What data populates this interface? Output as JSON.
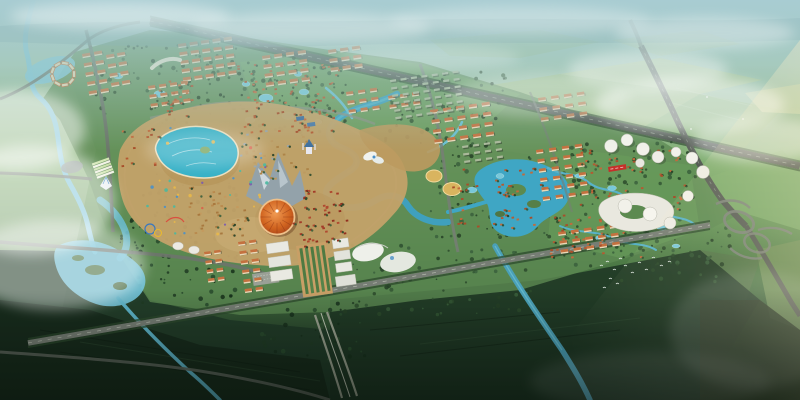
{
  "meta": {
    "title": "Aerial perspective rendering of a master-planned resort city: central theme park with lagoon and orange dome arena, residential districts, villa zones along canals, a lake, white CBD towers, crossing highways with cloverleaf interchange, misty horizon",
    "type": "architectural-aerial-rendering",
    "width_px": 800,
    "height_px": 400
  },
  "palette": {
    "sky_haze": "#a6cacf",
    "far_fields": "#9dbf85",
    "development_green": "#5d8a52",
    "dark_fields": "#1d3424",
    "water": "#55b2cc",
    "lagoon": "#35b0c6",
    "road_gray": "#6d746c",
    "highway_gray": "#555c55",
    "roof_orange": "#c4713f",
    "roof_red": "#a33b28",
    "facade_cream": "#ead9b8",
    "arena_orange": "#c75c24",
    "gold_roof": "#d9b45f",
    "tower_white": "#f2f1ea",
    "plaza_tan": "#c89f66",
    "banner_red": "#c5302a",
    "mist_white": "#ffffff",
    "sun_glow": "#f0d9a0"
  },
  "labels": {
    "sky": "Hazy teal sky over distant plain",
    "theme_park": "Theme park with lagoon, artificial mountain and dome arena",
    "arena": "Orange dome arena",
    "lake": "Central lake with islands",
    "interchange": "Cloverleaf highway interchange",
    "cbd": "White cylindrical tower cluster",
    "wetland": "Wetland park with canals",
    "commercial": "Commercial complex and axis plaza",
    "birds": "Flock of birds over fields"
  },
  "generated": {
    "tree_palette": [
      "#2b4a2c",
      "#335634",
      "#243f26",
      "#3a5f3c"
    ],
    "villa_palette": [
      "#b55a31",
      "#c26a3c",
      "#a84e2a"
    ],
    "roof_color": "#c4713f",
    "facade_color": "#ead9b8",
    "dense_roof": "#aab89a",
    "shadow_color": "#2f3a2c",
    "pond_color": "#78c8da",
    "bird_color": "#f2f7f4",
    "tree_regions": [
      {
        "x": 236,
        "y": 58,
        "w": 112,
        "h": 80,
        "n": 90,
        "s": 101
      },
      {
        "x": 86,
        "y": 42,
        "w": 150,
        "h": 72,
        "n": 70,
        "s": 102
      },
      {
        "x": 385,
        "y": 72,
        "w": 125,
        "h": 75,
        "n": 70,
        "s": 103
      },
      {
        "x": 430,
        "y": 155,
        "w": 120,
        "h": 85,
        "n": 85,
        "s": 104
      },
      {
        "x": 555,
        "y": 142,
        "w": 145,
        "h": 125,
        "n": 120,
        "s": 105
      },
      {
        "x": 115,
        "y": 190,
        "w": 125,
        "h": 115,
        "n": 95,
        "s": 106,
        "pal": [
          "#1e3a22",
          "#27492b",
          "#16301a"
        ]
      },
      {
        "x": 345,
        "y": 245,
        "w": 190,
        "h": 70,
        "n": 70,
        "s": 107
      },
      {
        "x": 615,
        "y": 228,
        "w": 115,
        "h": 55,
        "n": 45,
        "s": 108
      },
      {
        "x": 150,
        "y": 115,
        "w": 90,
        "h": 90,
        "n": 60,
        "s": 109
      },
      {
        "x": 250,
        "y": 300,
        "w": 120,
        "h": 60,
        "n": 40,
        "s": 110,
        "pal": [
          "#203c24",
          "#2a4c2e",
          "#182f1c"
        ]
      }
    ],
    "building_clusters": [
      {
        "x": 82,
        "y": 54,
        "cols": 2,
        "rows": 5,
        "dx": 12,
        "dy": 9.5,
        "w": 8,
        "h": 3.2,
        "a": -10
      },
      {
        "x": 106,
        "y": 55,
        "cols": 2,
        "rows": 4,
        "dx": 11,
        "dy": 9.5,
        "w": 8,
        "h": 3.2,
        "a": -10
      },
      {
        "x": 178,
        "y": 44,
        "cols": 5,
        "rows": 5,
        "dx": 11.5,
        "dy": 8.5,
        "w": 8,
        "h": 3.2,
        "a": -8
      },
      {
        "x": 148,
        "y": 86,
        "cols": 4,
        "rows": 3,
        "dx": 11,
        "dy": 9,
        "w": 7,
        "h": 3,
        "a": -8
      },
      {
        "x": 262,
        "y": 56,
        "cols": 4,
        "rows": 4,
        "dx": 12,
        "dy": 9,
        "w": 8,
        "h": 3.2,
        "a": -8
      },
      {
        "x": 328,
        "y": 50,
        "cols": 3,
        "rows": 3,
        "dx": 12,
        "dy": 9,
        "w": 8,
        "h": 3.2,
        "a": -8
      },
      {
        "x": 346,
        "y": 92,
        "cols": 3,
        "rows": 3,
        "dx": 12,
        "dy": 9,
        "w": 7,
        "h": 3,
        "a": -8
      },
      {
        "x": 388,
        "y": 96,
        "cols": 3,
        "rows": 2,
        "dx": 12,
        "dy": 9,
        "w": 7,
        "h": 3,
        "a": -8
      },
      {
        "x": 430,
        "y": 110,
        "cols": 5,
        "rows": 4,
        "dx": 13,
        "dy": 10,
        "w": 8,
        "h": 3.2,
        "a": -8
      },
      {
        "x": 538,
        "y": 98,
        "cols": 4,
        "rows": 3,
        "dx": 13,
        "dy": 10,
        "w": 7.5,
        "h": 3,
        "a": -8,
        "o": 0.85
      },
      {
        "x": 536,
        "y": 150,
        "cols": 4,
        "rows": 6,
        "dx": 13,
        "dy": 9.5,
        "w": 7,
        "h": 3,
        "a": -8
      },
      {
        "x": 558,
        "y": 232,
        "cols": 5,
        "rows": 3,
        "dx": 13,
        "dy": 9,
        "w": 7.5,
        "h": 3,
        "a": -8
      },
      {
        "x": 238,
        "y": 242,
        "cols": 2,
        "rows": 6,
        "dx": 11,
        "dy": 9.5,
        "w": 7,
        "h": 3,
        "a": -8
      },
      {
        "x": 204,
        "y": 252,
        "cols": 2,
        "rows": 4,
        "dx": 10,
        "dy": 9,
        "w": 6.5,
        "h": 2.8,
        "a": -8
      },
      {
        "x": 390,
        "y": 80,
        "cols": 7,
        "rows": 6,
        "dx": 10.5,
        "dy": 7.5,
        "w": 6,
        "h": 2.2,
        "a": -8,
        "style": "dense"
      },
      {
        "x": 462,
        "y": 146,
        "cols": 4,
        "rows": 3,
        "dx": 11,
        "dy": 7.5,
        "w": 6,
        "h": 2.2,
        "a": -8,
        "style": "dense"
      },
      {
        "ring": true,
        "cx": 63,
        "cy": 74,
        "r": 11,
        "count": 9,
        "w": 6.5,
        "h": 3
      }
    ],
    "villa_regions": [
      {
        "x": 236,
        "y": 64,
        "w": 104,
        "h": 68,
        "n": 78,
        "s": 7
      },
      {
        "x": 150,
        "y": 80,
        "w": 48,
        "h": 36,
        "n": 20,
        "s": 11
      },
      {
        "x": 576,
        "y": 148,
        "w": 112,
        "h": 64,
        "n": 58,
        "s": 13
      },
      {
        "x": 548,
        "y": 214,
        "w": 92,
        "h": 46,
        "n": 38,
        "s": 17
      },
      {
        "x": 452,
        "y": 168,
        "w": 92,
        "h": 60,
        "n": 46,
        "s": 19
      },
      {
        "x": 118,
        "y": 128,
        "w": 40,
        "h": 38,
        "n": 13,
        "s": 23
      },
      {
        "x": 292,
        "y": 188,
        "w": 54,
        "h": 58,
        "n": 46,
        "s": 29,
        "pal": [
          "#a33b28",
          "#93301f",
          "#b04a30"
        ]
      },
      {
        "x": 188,
        "y": 186,
        "w": 60,
        "h": 50,
        "n": 40,
        "s": 31,
        "pal": [
          "#b98a4e",
          "#a8793f",
          "#c49a5e"
        ]
      },
      {
        "x": 238,
        "y": 130,
        "w": 70,
        "h": 48,
        "n": 38,
        "s": 37,
        "pal": [
          "#bd9a60",
          "#ad8448",
          "#9aa5aa"
        ]
      },
      {
        "x": 140,
        "y": 128,
        "w": 130,
        "h": 110,
        "n": 34,
        "s": 41,
        "dots": true,
        "pal": [
          "#d9604a",
          "#e8b84a",
          "#4a90c8",
          "#7a5ab0",
          "#49b8a0"
        ]
      }
    ],
    "ponds": [
      [
        266,
        98,
        7,
        4
      ],
      [
        288,
        116,
        6,
        3.5
      ],
      [
        250,
        120,
        5,
        3
      ],
      [
        304,
        92,
        5,
        3
      ],
      [
        318,
        122,
        4,
        2.5
      ],
      [
        160,
        94,
        6,
        3.5
      ],
      [
        118,
        76,
        5,
        3
      ],
      [
        298,
        74,
        4,
        2.5
      ],
      [
        246,
        84,
        4,
        2.5
      ],
      [
        580,
        176,
        5,
        2.5
      ],
      [
        612,
        188,
        4.5,
        2.5
      ],
      [
        641,
        203,
        4.5,
        2.5
      ],
      [
        662,
        228,
        5,
        2.5
      ],
      [
        600,
        238,
        4.5,
        2.5
      ],
      [
        676,
        246,
        4,
        2
      ],
      [
        472,
        190,
        5,
        3
      ],
      [
        500,
        176,
        4,
        2.5
      ]
    ],
    "birds": [
      [
        600,
        266
      ],
      [
        606,
        262
      ],
      [
        613,
        270
      ],
      [
        619,
        259
      ],
      [
        624,
        266
      ],
      [
        631,
        273
      ],
      [
        609,
        279
      ],
      [
        616,
        284
      ],
      [
        603,
        288
      ],
      [
        638,
        263
      ],
      [
        645,
        270
      ],
      [
        652,
        258
      ],
      [
        660,
        266
      ],
      [
        668,
        262
      ]
    ],
    "mist": [
      {
        "x": 30,
        "y": 200,
        "rx": 85,
        "ry": 55,
        "o": 0.5
      },
      {
        "x": 55,
        "y": 265,
        "rx": 90,
        "ry": 45,
        "o": 0.42
      },
      {
        "x": 15,
        "y": 130,
        "rx": 70,
        "ry": 40,
        "o": 0.5
      },
      {
        "x": 690,
        "y": 105,
        "rx": 95,
        "ry": 28,
        "o": 0.5
      },
      {
        "x": 762,
        "y": 140,
        "rx": 70,
        "ry": 22,
        "o": 0.45
      },
      {
        "x": 648,
        "y": 70,
        "rx": 80,
        "ry": 20,
        "o": 0.4
      },
      {
        "x": 540,
        "y": 95,
        "rx": 90,
        "ry": 22,
        "o": 0.28
      },
      {
        "x": 310,
        "y": 28,
        "rx": 120,
        "ry": 16,
        "o": 0.35
      },
      {
        "x": 120,
        "y": 16,
        "rx": 110,
        "ry": 14,
        "o": 0.4
      },
      {
        "x": 520,
        "y": 20,
        "rx": 130,
        "ry": 14,
        "o": 0.3
      },
      {
        "x": 705,
        "y": 33,
        "rx": 90,
        "ry": 16,
        "o": 0.35
      },
      {
        "x": 430,
        "y": 58,
        "rx": 90,
        "ry": 14,
        "o": 0.22
      },
      {
        "x": 205,
        "y": 150,
        "rx": 60,
        "ry": 18,
        "o": 0.22
      },
      {
        "x": 755,
        "y": 330,
        "rx": 85,
        "ry": 60,
        "o": 0.12
      },
      {
        "x": 650,
        "y": 382,
        "rx": 120,
        "ry": 30,
        "o": 0.1
      }
    ]
  }
}
